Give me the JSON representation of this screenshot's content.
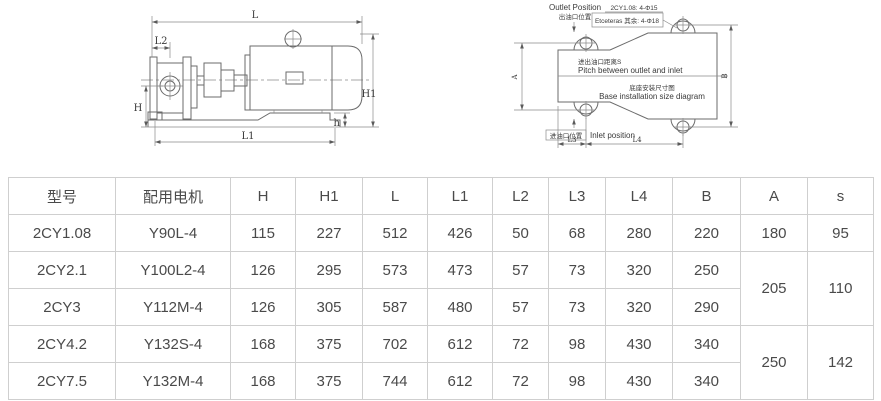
{
  "diagram_side": {
    "labels": {
      "L": "L",
      "L2": "L2",
      "H": "H",
      "H1": "H1",
      "h": "h",
      "L1": "L1"
    }
  },
  "diagram_base": {
    "outlet_en": "Outlet Position",
    "outlet_zh": "出油口位置",
    "note_line1": "2CY1.08: 4-Φ15",
    "note_line2": "Etceteras 其余: 4-Φ18",
    "pitch_zh": "进出油口距离S",
    "pitch_en": "Pitch between outlet and inlet",
    "title_zh": "底座安装尺寸图",
    "title_en": "Base installation size diagram",
    "inlet_zh": "进油口位置",
    "inlet_en": "Inlet position",
    "dim_A": "A",
    "dim_B": "B",
    "dim_L3": "L3",
    "dim_L4": "L4"
  },
  "table": {
    "border_color": "#cfcfcf",
    "text_color": "#4a4a4a",
    "headers": [
      "型号",
      "配用电机",
      "H",
      "H1",
      "L",
      "L1",
      "L2",
      "L3",
      "L4",
      "B",
      "A",
      "s"
    ],
    "rows": [
      {
        "cells": [
          {
            "t": "2CY1.08"
          },
          {
            "t": "Y90L-4"
          },
          {
            "t": "115"
          },
          {
            "t": "227"
          },
          {
            "t": "512"
          },
          {
            "t": "426"
          },
          {
            "t": "50"
          },
          {
            "t": "68"
          },
          {
            "t": "280"
          },
          {
            "t": "220"
          },
          {
            "t": "180"
          },
          {
            "t": "95"
          }
        ]
      },
      {
        "cells": [
          {
            "t": "2CY2.1"
          },
          {
            "t": "Y100L2-4"
          },
          {
            "t": "126"
          },
          {
            "t": "295"
          },
          {
            "t": "573"
          },
          {
            "t": "473"
          },
          {
            "t": "57"
          },
          {
            "t": "73"
          },
          {
            "t": "320"
          },
          {
            "t": "250"
          },
          {
            "t": "205",
            "rowspan": 2
          },
          {
            "t": "110",
            "rowspan": 2
          }
        ]
      },
      {
        "cells": [
          {
            "t": "2CY3"
          },
          {
            "t": "Y112M-4"
          },
          {
            "t": "126"
          },
          {
            "t": "305"
          },
          {
            "t": "587"
          },
          {
            "t": "480"
          },
          {
            "t": "57"
          },
          {
            "t": "73"
          },
          {
            "t": "320"
          },
          {
            "t": "290"
          }
        ]
      },
      {
        "cells": [
          {
            "t": "2CY4.2"
          },
          {
            "t": "Y132S-4"
          },
          {
            "t": "168"
          },
          {
            "t": "375"
          },
          {
            "t": "702"
          },
          {
            "t": "612"
          },
          {
            "t": "72"
          },
          {
            "t": "98"
          },
          {
            "t": "430"
          },
          {
            "t": "340"
          },
          {
            "t": "250",
            "rowspan": 2
          },
          {
            "t": "142",
            "rowspan": 2
          }
        ]
      },
      {
        "cells": [
          {
            "t": "2CY7.5"
          },
          {
            "t": "Y132M-4"
          },
          {
            "t": "168"
          },
          {
            "t": "375"
          },
          {
            "t": "744"
          },
          {
            "t": "612"
          },
          {
            "t": "72"
          },
          {
            "t": "98"
          },
          {
            "t": "430"
          },
          {
            "t": "340"
          }
        ]
      }
    ]
  }
}
